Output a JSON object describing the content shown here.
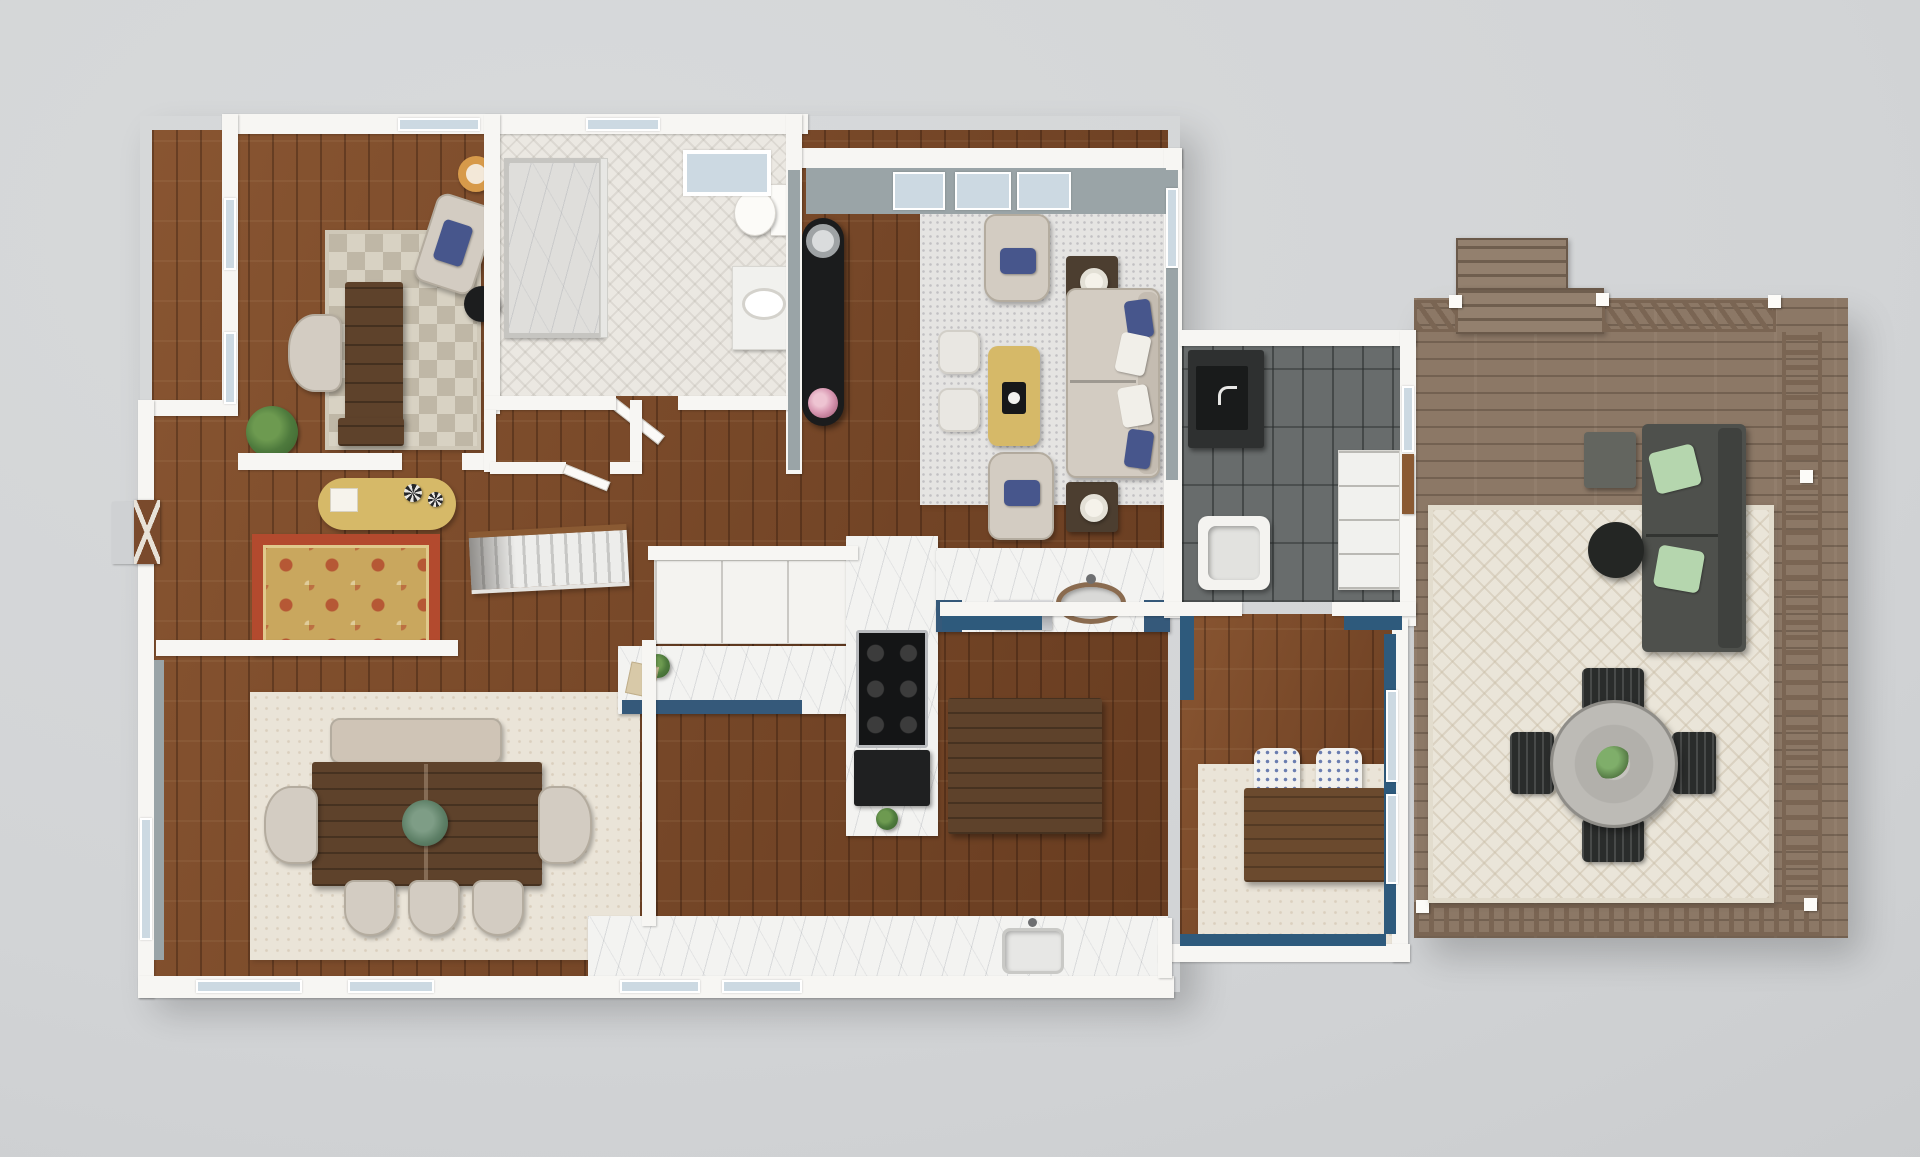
{
  "scene": {
    "description": "Photorealistic 3D rendered top-down floor plan of a single-story home with attached wood deck",
    "view": "top-down dollhouse render",
    "background": "#d3d5d7"
  },
  "palette": {
    "background": "#d3d5d7",
    "wall_white": "#f7f6f3",
    "interior_wall_grey": "#9aa4a7",
    "accent_wall_blue": "#2e5a7c",
    "hardwood": "#7b4827",
    "deck_wood": "#8c7866",
    "tile_dark_grey": "#686c6c",
    "marble_white": "#f3f3f1",
    "herringbone_tile": "#ebe8e2",
    "cabinet_navy": "#35597a",
    "rug_living_grey": "#e5e4e2",
    "rug_dining_cream": "#eae4d8",
    "rug_checker_beige": "#d8d2c3",
    "rug_oriental_red": "#b34a2e",
    "rug_oriental_gold": "#c9a75e",
    "rug_outdoor_cream": "#eae5d9",
    "upholstery_beige": "#d3ccc2",
    "pillow_navy": "#47568c",
    "gold_accent": "#d6b968",
    "island_walnut": "#5e422b",
    "outdoor_sofa_grey": "#4e504c",
    "outdoor_pillow_green": "#b5d6ae",
    "stair_rail_oak": "#8a5a33",
    "front_door_wood": "#7a4a2c",
    "window_glass": "#ccd9e2"
  },
  "rooms": [
    {
      "id": "office",
      "name": "Office",
      "floor": "hardwood",
      "furniture": [
        "executive desk",
        "desk chair",
        "accent armchair with navy pillow",
        "checkered area rug",
        "round black side table",
        "floor lamp",
        "potted plant"
      ]
    },
    {
      "id": "bathroom",
      "name": "Bathroom",
      "floor": "herringbone tile",
      "furniture": [
        "walk-in marble shower",
        "toilet",
        "vanity with oval sink",
        "skylight",
        "linen closet"
      ]
    },
    {
      "id": "living-room",
      "name": "Living Room",
      "floor": "hardwood",
      "furniture": [
        "beige sofa with navy and white pillows",
        "two accent armchairs",
        "gold ottoman coffee table",
        "two white pouf ottomans",
        "two lamp side tables",
        "black curved console with flowers",
        "grey area rug"
      ]
    },
    {
      "id": "entry-hall",
      "name": "Entry Hall",
      "floor": "hardwood",
      "furniture": [
        "cross-buck front door",
        "curved gold console table",
        "oriental area rug",
        "staircase to lower level"
      ]
    },
    {
      "id": "dining-room",
      "name": "Dining Room",
      "floor": "hardwood",
      "furniture": [
        "plank dining table",
        "upholstered bench",
        "five upholstered chairs",
        "cream area rug",
        "greenery centerpiece"
      ]
    },
    {
      "id": "kitchen",
      "name": "Kitchen",
      "floor": "hardwood",
      "furniture": [
        "L-shaped marble counter with navy cabinet faces",
        "gas cooktop",
        "black lower cabinet",
        "walnut island",
        "pantry cabinets",
        "peninsula with bronze sink and dishwasher",
        "rear counter with sink"
      ]
    },
    {
      "id": "mudroom-laundry",
      "name": "Mudroom / Laundry",
      "floor": "dark grey tile",
      "furniture": [
        "utility counter with dark sink",
        "laundry basin",
        "open shelving",
        "glass door to deck"
      ]
    },
    {
      "id": "breakfast-nook",
      "name": "Breakfast Nook",
      "floor": "hardwood",
      "furniture": [
        "wood buffet table",
        "two blue patterned chairs",
        "cream diamond rug",
        "navy accent walls with deck windows"
      ]
    },
    {
      "id": "deck",
      "name": "Deck",
      "floor": "wood decking",
      "furniture": [
        "outdoor sectional with green pillows",
        "round black coffee table",
        "grey side table",
        "round outdoor dining table",
        "four black slat chairs",
        "cream outdoor rug",
        "deck stairs",
        "slatted wood railing"
      ]
    }
  ]
}
